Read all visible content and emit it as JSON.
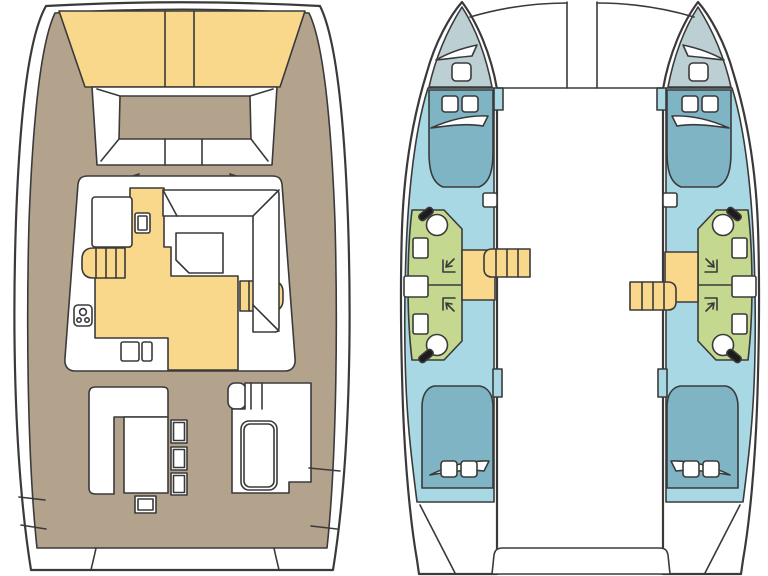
{
  "colors": {
    "background": "#ffffff",
    "outline": "#3a3a3a",
    "hull_white": "#ffffff",
    "deck_tan": "#b3a38d",
    "cushion_yellow": "#f9d88c",
    "cabin_blue": "#a9d8e5",
    "bed_blue": "#7fb4c5",
    "bow_gray": "#bccfd3",
    "bath_green": "#c4d98f",
    "detail_black": "#1c1c1c"
  },
  "diagram": {
    "type": "boat-floor-plan",
    "vessel": "catamaran",
    "views": {
      "left": {
        "name": "deck-plan"
      },
      "right": {
        "name": "accommodation-plan"
      }
    },
    "deck_plan_features": [
      "bow-trampoline-pads",
      "bow-cockpit-seating",
      "saloon",
      "galley-counter",
      "galley-stove",
      "galley-sink",
      "dinette-sofa",
      "dinette-table",
      "companionway-port",
      "companionway-starboard",
      "cockpit-bench",
      "cockpit-table",
      "cockpit-stools",
      "helm-seat",
      "side-deck-steps",
      "transom-platform"
    ],
    "accommodation_plan_features": [
      "port-hull",
      "starboard-hull",
      "forepeak-locker",
      "forward-cabin",
      "forward-berth",
      "head-compartment",
      "shower-corner",
      "toilet",
      "washbasin",
      "hull-stairs",
      "aft-cabin",
      "aft-berth",
      "deck-hatches",
      "tender-platform",
      "bridgedeck"
    ]
  }
}
